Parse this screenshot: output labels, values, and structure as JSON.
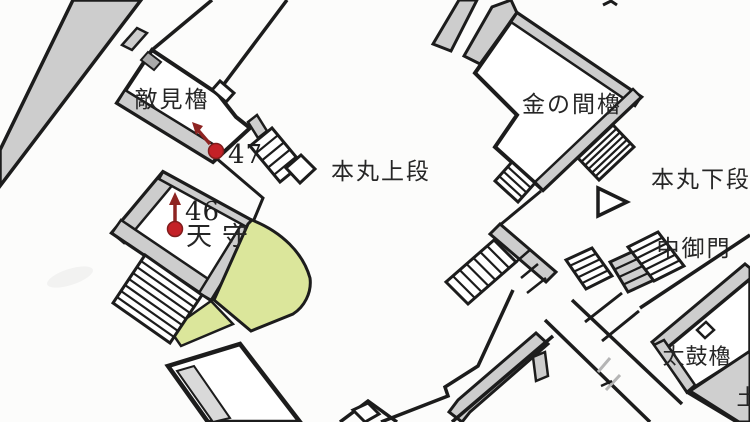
{
  "map": {
    "kind": "hand-drawn castle plan",
    "labels": {
      "tekimi_yagura": "敵見櫓",
      "honmaru_jodan": "本丸上段",
      "kin_no_ma_yagura": "金の間櫓",
      "honmaru_gedan": "本丸下段",
      "naka_gomon": "中御門",
      "tenshu": "天守",
      "taiko_yagura": "太鼓櫓",
      "edge_partial": "土"
    },
    "markers": [
      {
        "number": "46"
      },
      {
        "number": "47"
      }
    ],
    "colors": {
      "marker_dot": "#c42127",
      "marker_arrow": "#8e2422",
      "lawn_green": "#dbe69b",
      "wall_gray": "#cdcdcd",
      "line_black": "#1c1c1c",
      "paper": "#fcfcfb"
    }
  }
}
